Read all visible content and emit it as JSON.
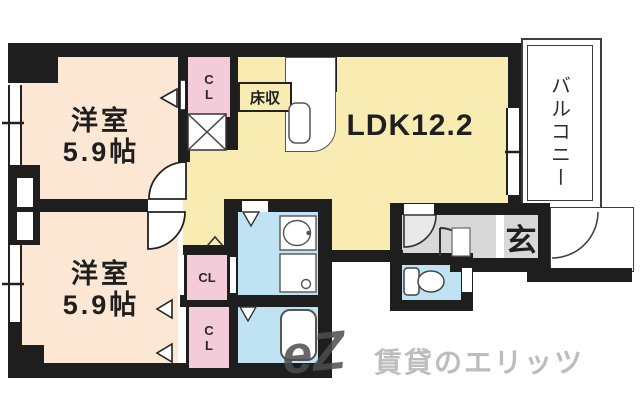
{
  "plan": {
    "room1": {
      "name": "洋室",
      "size": "5.9帖"
    },
    "room2": {
      "name": "洋室",
      "size": "5.9帖"
    },
    "ldk": {
      "label": "LDK12.2"
    },
    "balcony": {
      "label": "バルコニー"
    },
    "entrance": {
      "label": "玄"
    },
    "closets": {
      "top": "CL",
      "middle": "CL",
      "bottom": "CL"
    },
    "floor_storage": {
      "label": "床収"
    }
  },
  "watermark": {
    "logo": "eZ",
    "text": "賃貸のエリッツ"
  },
  "colors": {
    "wall": "#1e1e1e",
    "room_peach": "#fbe7d3",
    "ldk_yellow": "#f9ecb2",
    "closet_pink": "#f3cbd9",
    "wet_blue": "#bfe3f2",
    "hall_gray": "#d8d8d8",
    "watermark_gray": "#bdbdbd"
  }
}
